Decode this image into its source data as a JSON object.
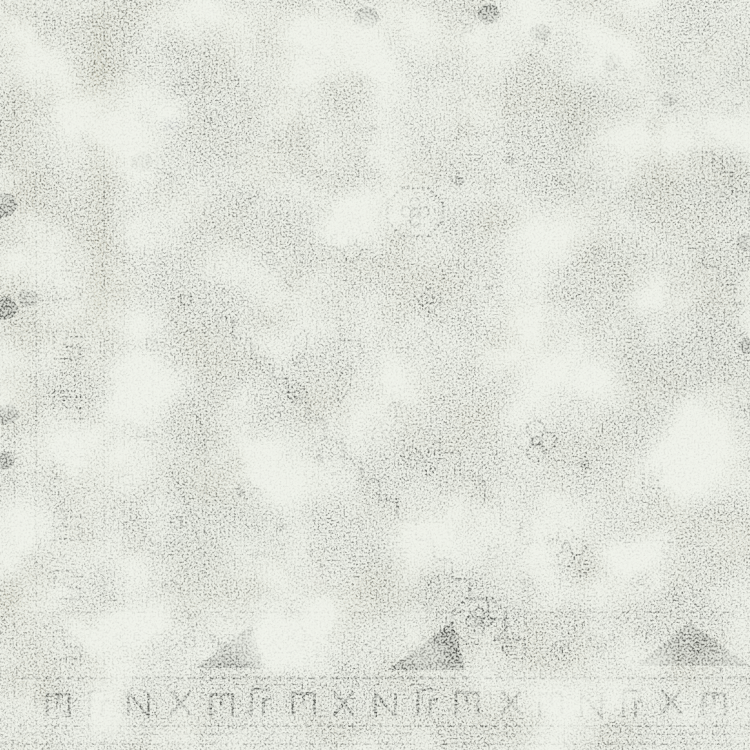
{
  "scene": {
    "type": "photograph",
    "subject": "Close-up corner detail of a distressed vintage tribal rug with faded charcoal geometric motifs on an ivory ground"
  },
  "palette": {
    "ground": "#e9ebe4",
    "ground_shadow": "#c9cdc2",
    "white_wear": "#f4f5f0",
    "khaki": "#c4c0a8",
    "dark_khaki": "#b2ad92",
    "pale_sage": "#ccd3c9",
    "cool_gray": "#c3c8c5",
    "charcoal": "#3c3e3a",
    "mid_gray": "#70736c",
    "faded_gray": "#9aa094",
    "lavender_hint": "#b9bac9",
    "blush_hint": "#d9cfd0"
  },
  "texture": {
    "seed": 11,
    "mottle_freq": 0.016,
    "coarse_freq": 0.012,
    "fine_freq": 0.5,
    "grain_freq": 0.55
  },
  "washes": [
    [
      560,
      55,
      190,
      150,
      "faded_gray",
      0.16
    ],
    [
      615,
      245,
      135,
      180,
      "faded_gray",
      0.12
    ],
    [
      160,
      425,
      150,
      200,
      "pale_sage",
      0.2
    ],
    [
      370,
      545,
      170,
      90,
      "faded_gray",
      0.14
    ],
    [
      60,
      0,
      70,
      335,
      "khaki",
      0.2
    ],
    [
      92,
      0,
      16,
      335,
      "dark_khaki",
      0.25
    ],
    [
      0,
      0,
      40,
      340,
      "khaki",
      0.28
    ],
    [
      0,
      330,
      30,
      95,
      "khaki",
      0.3
    ],
    [
      0,
      555,
      55,
      150,
      "khaki",
      0.22
    ],
    [
      330,
      0,
      34,
      330,
      "khaki",
      0.12
    ],
    [
      700,
      30,
      50,
      180,
      "cool_gray",
      0.15
    ],
    [
      256,
      60,
      64,
      70,
      "khaki",
      0.12
    ],
    [
      163,
      118,
      16,
      13,
      "lavender_hint",
      0.5
    ],
    [
      306,
      570,
      20,
      15,
      "blush_hint",
      0.45
    ],
    [
      583,
      366,
      12,
      9,
      "lavender_hint",
      0.35
    ],
    [
      355,
      275,
      190,
      150,
      "white_wear",
      0.4
    ],
    [
      55,
      115,
      95,
      170,
      "white_wear",
      0.3
    ],
    [
      425,
      550,
      140,
      95,
      "white_wear",
      0.35
    ]
  ],
  "left_border": {
    "guards": [
      [
        14,
        0,
        750,
        1.5,
        0.3
      ],
      [
        22,
        0,
        750,
        1,
        0.2
      ],
      [
        36,
        0,
        750,
        2,
        0.5
      ],
      [
        47,
        0,
        340,
        1,
        0.25
      ],
      [
        104,
        0,
        750,
        1.6,
        0.45
      ],
      [
        113,
        0,
        750,
        1,
        0.28
      ],
      [
        124,
        0,
        750,
        1.5,
        0.38
      ],
      [
        153,
        330,
        705,
        1.4,
        0.32
      ],
      [
        205,
        0,
        645,
        1.4,
        0.3
      ],
      [
        216,
        0,
        645,
        1,
        0.22
      ],
      [
        300,
        0,
        332,
        1.4,
        0.26
      ],
      [
        310,
        0,
        332,
        1,
        0.2
      ],
      [
        336,
        0,
        330,
        1,
        0.15
      ],
      [
        262,
        0,
        330,
        1,
        0.13
      ]
    ],
    "lines": [
      [
        30,
        85,
        190,
        85,
        1,
        0.15
      ],
      [
        10,
        332,
        212,
        332,
        1.5,
        0.25
      ],
      [
        30,
        700,
        130,
        700,
        1.5,
        0.2
      ]
    ],
    "hooks": [
      [
        70,
        285,
        0.5
      ],
      [
        70,
        345,
        0.6
      ],
      [
        70,
        405,
        0.62
      ],
      [
        70,
        465,
        0.58
      ],
      [
        70,
        525,
        0.6
      ],
      [
        70,
        585,
        0.62
      ],
      [
        70,
        645,
        0.55
      ]
    ],
    "squares": [
      [
        152,
        345,
        0.45
      ],
      [
        186,
        300,
        0.45
      ],
      [
        142,
        432,
        0.45
      ],
      [
        176,
        522,
        0.45
      ],
      [
        152,
        602,
        0.45
      ],
      [
        190,
        642,
        0.45
      ],
      [
        128,
        480,
        0.4
      ],
      [
        170,
        586,
        0.4
      ],
      [
        180,
        90,
        0.25
      ],
      [
        150,
        250,
        0.2
      ]
    ],
    "curves": [
      [
        "M128,318 Q196,372 208,462",
        0.5
      ],
      [
        "M126,420 Q188,470 202,556",
        0.45
      ],
      [
        "M130,516 Q182,566 196,644",
        0.45
      ],
      [
        "M22,552 L158,652",
        0.55
      ],
      [
        "M38,546 L172,640",
        0.4
      ],
      [
        "M40,95 L120,180",
        0.18
      ],
      [
        "M120,95 L40,180",
        0.18
      ],
      [
        "M40,200 L120,285",
        0.18
      ],
      [
        "M120,200 L40,285",
        0.18
      ]
    ]
  },
  "field": {
    "stairs": [
      [
        215,
        318,
        525,
        660,
        18,
        2.4,
        0.6
      ],
      [
        238,
        345,
        505,
        638,
        18,
        1.8,
        0.3
      ],
      [
        320,
        318,
        560,
        588,
        20,
        2,
        0.35
      ],
      [
        640,
        92,
        750,
        212,
        17,
        2.4,
        0.55
      ],
      [
        545,
        22,
        640,
        92,
        16,
        1.8,
        0.3
      ],
      [
        688,
        248,
        750,
        322,
        15,
        2.2,
        0.5
      ],
      [
        700,
        338,
        750,
        425,
        14,
        2.2,
        0.45
      ],
      [
        128,
        120,
        172,
        200,
        14,
        2,
        0.4
      ]
    ],
    "motifs": [
      {
        "t": "octagon",
        "x": 415,
        "y": 212,
        "s": 1,
        "r": 0,
        "o": 0.8
      },
      {
        "t": "octagon",
        "x": 479,
        "y": 621,
        "s": 0.95,
        "r": 0,
        "o": 0.7
      },
      {
        "t": "quatrefoil",
        "x": 352,
        "y": 241,
        "s": 1,
        "r": 0,
        "o": 0.75
      },
      {
        "t": "quatrefoil",
        "x": 536,
        "y": 441,
        "s": 1,
        "r": 0,
        "o": 0.8
      },
      {
        "t": "quatrefoil",
        "x": 566,
        "y": 547,
        "s": 0.95,
        "r": 0,
        "o": 0.8
      },
      {
        "t": "quatrefoil",
        "x": 468,
        "y": 28,
        "s": 0.9,
        "r": 0,
        "o": 0.5
      },
      {
        "t": "quatrefoil",
        "x": 463,
        "y": 98,
        "s": 0.7,
        "r": 0,
        "o": 0.35
      },
      {
        "t": "quatrefoil",
        "x": 614,
        "y": 186,
        "s": 0.8,
        "r": 0,
        "o": 0.3
      },
      {
        "t": "quatrefoil",
        "x": 300,
        "y": 645,
        "s": 0.8,
        "r": 0,
        "o": 0.5
      },
      {
        "t": "quatrefoil",
        "x": 253,
        "y": 200,
        "s": 0.8,
        "r": 0,
        "o": 0.25
      },
      {
        "t": "quatrefoil",
        "x": 427,
        "y": 350,
        "s": 0.6,
        "r": 0,
        "o": 0.35
      },
      {
        "t": "rosette",
        "x": 247,
        "y": 489,
        "s": 0.9,
        "r": 0,
        "o": 0.6
      },
      {
        "t": "rosette",
        "x": 267,
        "y": 598,
        "s": 0.8,
        "r": 0,
        "o": 0.55
      },
      {
        "t": "rosette",
        "x": 645,
        "y": 133,
        "s": 0.9,
        "r": 0,
        "o": 0.3
      },
      {
        "t": "rosette",
        "x": 703,
        "y": 77,
        "s": 0.9,
        "r": 0,
        "o": 0.28
      },
      {
        "t": "rosette",
        "x": 580,
        "y": 300,
        "s": 0.7,
        "r": 0,
        "o": 0.3
      },
      {
        "t": "rosette",
        "x": 322,
        "y": 286,
        "s": 0.6,
        "r": 0,
        "o": 0.4
      },
      {
        "t": "rosette",
        "x": 700,
        "y": 600,
        "s": 0.8,
        "r": 0,
        "o": 0.4
      },
      {
        "t": "diamond",
        "x": 317,
        "y": 61,
        "s": 0.9,
        "r": 0,
        "o": 0.7
      },
      {
        "t": "diamond",
        "x": 360,
        "y": 72,
        "s": 0.8,
        "r": 0,
        "o": 0.5
      },
      {
        "t": "diamond",
        "x": 303,
        "y": 90,
        "s": 0.7,
        "r": 0,
        "o": 0.5
      },
      {
        "t": "diamond",
        "x": 430,
        "y": 300,
        "s": 1,
        "r": 0,
        "o": 0.65
      },
      {
        "t": "diamond",
        "x": 270,
        "y": 262,
        "s": 0.9,
        "r": 0,
        "o": 0.6
      },
      {
        "t": "diamond",
        "x": 297,
        "y": 394,
        "s": 0.9,
        "r": 0,
        "o": 0.6
      },
      {
        "t": "diamond",
        "x": 412,
        "y": 457,
        "s": 0.9,
        "r": 0,
        "o": 0.6
      },
      {
        "t": "diamond",
        "x": 596,
        "y": 252,
        "s": 0.9,
        "r": 0,
        "o": 0.45
      },
      {
        "t": "diamond",
        "x": 628,
        "y": 545,
        "s": 0.9,
        "r": 0,
        "o": 0.55
      },
      {
        "t": "diamond",
        "x": 663,
        "y": 562,
        "s": 0.9,
        "r": 0,
        "o": 0.5
      },
      {
        "t": "diamond",
        "x": 641,
        "y": 582,
        "s": 0.9,
        "r": 0,
        "o": 0.55
      },
      {
        "t": "diamond",
        "x": 676,
        "y": 598,
        "s": 0.85,
        "r": 0,
        "o": 0.5
      },
      {
        "t": "diamond",
        "x": 610,
        "y": 598,
        "s": 0.8,
        "r": 0,
        "o": 0.45
      },
      {
        "t": "diamond",
        "x": 196,
        "y": 80,
        "s": 0.8,
        "r": 0,
        "o": 0.3
      },
      {
        "t": "diamond",
        "x": 560,
        "y": 650,
        "s": 0.8,
        "r": 0,
        "o": 0.5
      },
      {
        "t": "diamond",
        "x": 523,
        "y": 582,
        "s": 0.8,
        "r": 0,
        "o": 0.5
      },
      {
        "t": "cross",
        "x": 459,
        "y": 181,
        "s": 0.9,
        "r": 0,
        "o": 0.6
      },
      {
        "t": "cross",
        "x": 509,
        "y": 160,
        "s": 0.8,
        "r": 0,
        "o": 0.5
      },
      {
        "t": "cross",
        "x": 585,
        "y": 464,
        "s": 0.9,
        "r": 0,
        "o": 0.6
      },
      {
        "t": "cross",
        "x": 489,
        "y": 287,
        "s": 0.7,
        "r": 0,
        "o": 0.45
      },
      {
        "t": "cross",
        "x": 560,
        "y": 180,
        "s": 0.7,
        "r": 0,
        "o": 0.35
      },
      {
        "t": "cross",
        "x": 210,
        "y": 120,
        "s": 0.7,
        "r": 0,
        "o": 0.3
      },
      {
        "t": "cross",
        "x": 372,
        "y": 128,
        "s": 0.7,
        "r": 0,
        "o": 0.4
      },
      {
        "t": "cross",
        "x": 240,
        "y": 492,
        "s": 0.8,
        "r": 0,
        "o": 0.55
      },
      {
        "t": "cross",
        "x": 280,
        "y": 527,
        "s": 0.8,
        "r": 0,
        "o": 0.5
      },
      {
        "t": "cross",
        "x": 320,
        "y": 458,
        "s": 0.8,
        "r": 0,
        "o": 0.5
      },
      {
        "t": "cross",
        "x": 255,
        "y": 555,
        "s": 0.7,
        "r": 0,
        "o": 0.45
      },
      {
        "t": "cross",
        "x": 310,
        "y": 552,
        "s": 0.7,
        "r": 0,
        "o": 0.45
      },
      {
        "t": "leaf",
        "x": 300,
        "y": 348,
        "s": 1,
        "r": -35,
        "o": 0.65
      },
      {
        "t": "leaf",
        "x": 344,
        "y": 384,
        "s": 1,
        "r": -35,
        "o": 0.6
      },
      {
        "t": "leaf",
        "x": 389,
        "y": 421,
        "s": 1,
        "r": -35,
        "o": 0.65
      },
      {
        "t": "leaf",
        "x": 433,
        "y": 459,
        "s": 1,
        "r": -35,
        "o": 0.6
      },
      {
        "t": "leaf",
        "x": 478,
        "y": 499,
        "s": 1,
        "r": -35,
        "o": 0.6
      },
      {
        "t": "leaf",
        "x": 523,
        "y": 539,
        "s": 1,
        "r": -35,
        "o": 0.6
      },
      {
        "t": "leaf",
        "x": 540,
        "y": 42,
        "s": 0.9,
        "r": -20,
        "o": 0.7
      },
      {
        "t": "leaf",
        "x": 586,
        "y": 561,
        "s": 0.9,
        "r": -35,
        "o": 0.5
      },
      {
        "t": "leaf",
        "x": 641,
        "y": 637,
        "s": 0.9,
        "r": -35,
        "o": 0.5
      },
      {
        "t": "leaf",
        "x": 432,
        "y": 592,
        "s": 0.9,
        "r": -30,
        "o": 0.5
      },
      {
        "t": "leaf",
        "x": 568,
        "y": 118,
        "s": 0.8,
        "r": -25,
        "o": 0.35
      },
      {
        "t": "hookL",
        "x": 655,
        "y": 478,
        "s": 1,
        "r": 0,
        "o": 0.7
      },
      {
        "t": "hookL",
        "x": 743,
        "y": 408,
        "s": 0.9,
        "r": 0,
        "o": 0.55
      },
      {
        "t": "xmark",
        "x": 170,
        "y": 150,
        "s": 1,
        "r": 0,
        "o": 0.22
      },
      {
        "t": "xmark",
        "x": 232,
        "y": 162,
        "s": 0.8,
        "r": 0,
        "o": 0.25
      },
      {
        "t": "blob",
        "x": 367,
        "y": 18,
        "s": 1,
        "r": 0,
        "o": 0.85
      },
      {
        "t": "blob",
        "x": 489,
        "y": 14,
        "s": 0.9,
        "r": 0,
        "o": 0.8
      },
      {
        "t": "blob",
        "x": 540,
        "y": 33,
        "s": 0.8,
        "r": 0,
        "o": 0.7
      },
      {
        "t": "blob",
        "x": 612,
        "y": 62,
        "s": 0.8,
        "r": 0,
        "o": 0.5
      },
      {
        "t": "blob",
        "x": 668,
        "y": 100,
        "s": 0.7,
        "r": 0,
        "o": 0.4
      },
      {
        "t": "blob",
        "x": 4,
        "y": 205,
        "s": 1.1,
        "r": 0,
        "o": 0.75
      },
      {
        "t": "blob",
        "x": 6,
        "y": 308,
        "s": 1,
        "r": 0,
        "o": 0.7
      },
      {
        "t": "blob",
        "x": 8,
        "y": 414,
        "s": 0.9,
        "r": 0,
        "o": 0.65
      },
      {
        "t": "blob",
        "x": 5,
        "y": 460,
        "s": 0.8,
        "r": 0,
        "o": 0.6
      },
      {
        "t": "blob",
        "x": 747,
        "y": 242,
        "s": 0.8,
        "r": 0,
        "o": 0.5
      },
      {
        "t": "blob",
        "x": 748,
        "y": 346,
        "s": 0.7,
        "r": 0,
        "o": 0.45
      },
      {
        "t": "blob",
        "x": 28,
        "y": 298,
        "s": 0.8,
        "r": 0,
        "o": 0.5
      },
      {
        "t": "blob",
        "x": 142,
        "y": 162,
        "s": 0.9,
        "r": 0,
        "o": 0.45
      }
    ]
  },
  "bottom_border": {
    "lines": [
      [
        612,
        28,
        750,
        1.5,
        0.4
      ],
      [
        618,
        28,
        750,
        1,
        0.22
      ],
      [
        678,
        22,
        750,
        2.4,
        0.5
      ],
      [
        685,
        22,
        750,
        1,
        0.28
      ],
      [
        716,
        55,
        750,
        1,
        0.2
      ],
      [
        726,
        18,
        750,
        2,
        0.45
      ],
      [
        734,
        18,
        750,
        1.4,
        0.3
      ],
      [
        744,
        0,
        750,
        2,
        0.35
      ]
    ],
    "zigzag": {
      "start": 55,
      "step": 95,
      "count": 8,
      "y_top": 624,
      "y_bot": 672,
      "motif_dx": 72,
      "motif_y": 647
    },
    "triangles": [
      {
        "pts": "388,670 452,622 466,670",
        "o": 0.75
      },
      {
        "pts": "196,668 252,624 264,668",
        "o": 0.5
      },
      {
        "pts": "690,622 750,666 636,666",
        "o": 0.45
      }
    ],
    "meander": {
      "tokens": [
        "pi",
        "el",
        "n",
        "x",
        "pi",
        "el",
        "pi",
        "x",
        "n",
        "el",
        "pi",
        "x",
        "pi",
        "n",
        "el",
        "x",
        "pi"
      ],
      "start_x": 58,
      "step": 41,
      "y": 702,
      "o": 0.72
    }
  }
}
